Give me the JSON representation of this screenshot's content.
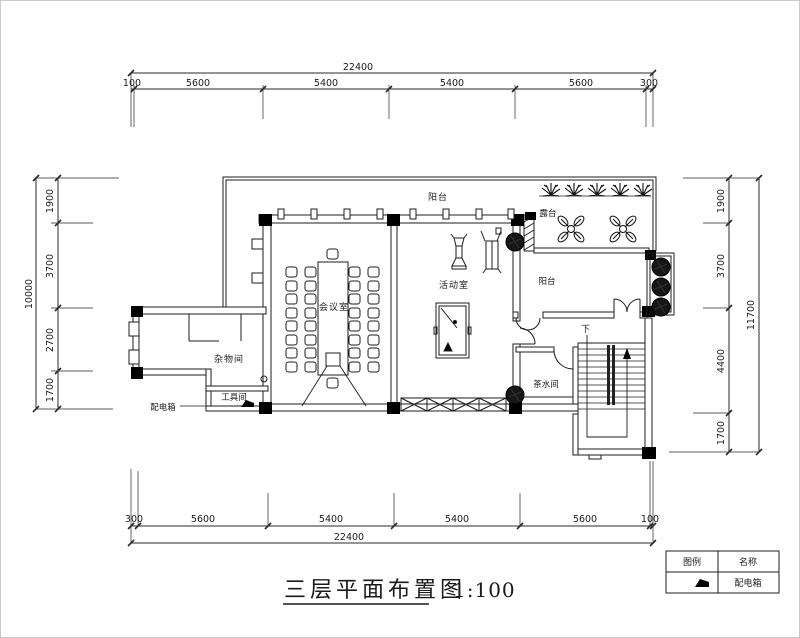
{
  "title": {
    "text": "三层平面布置图",
    "scale": "1:100"
  },
  "dimensions": {
    "top": {
      "overall": "22400",
      "segments": [
        "100",
        "5600",
        "5400",
        "5400",
        "5600",
        "300"
      ]
    },
    "bottom": {
      "overall": "22400",
      "segments": [
        "300",
        "5600",
        "5400",
        "5400",
        "5600",
        "100"
      ]
    },
    "left": {
      "overall": "10000",
      "segments": [
        "1900",
        "3700",
        "2700",
        "1700"
      ]
    },
    "right": {
      "overall": "11700",
      "segments": [
        "1900",
        "3700",
        "4400",
        "1700"
      ]
    }
  },
  "labels": {
    "balcony_top": "阳台",
    "terrace": "露台",
    "balcony_right": "阳台",
    "meeting_room": "会议室",
    "activity_room": "活动室",
    "storage_room": "杂物间",
    "tool_room": "工具间",
    "tea_room": "茶水间",
    "distribution_box": "配电箱",
    "stairs_down": "下"
  },
  "legend": {
    "headers": [
      "图例",
      "名称"
    ],
    "rows": [
      {
        "symbol_icon": "distribution-box-icon",
        "name": "配电箱"
      }
    ]
  }
}
